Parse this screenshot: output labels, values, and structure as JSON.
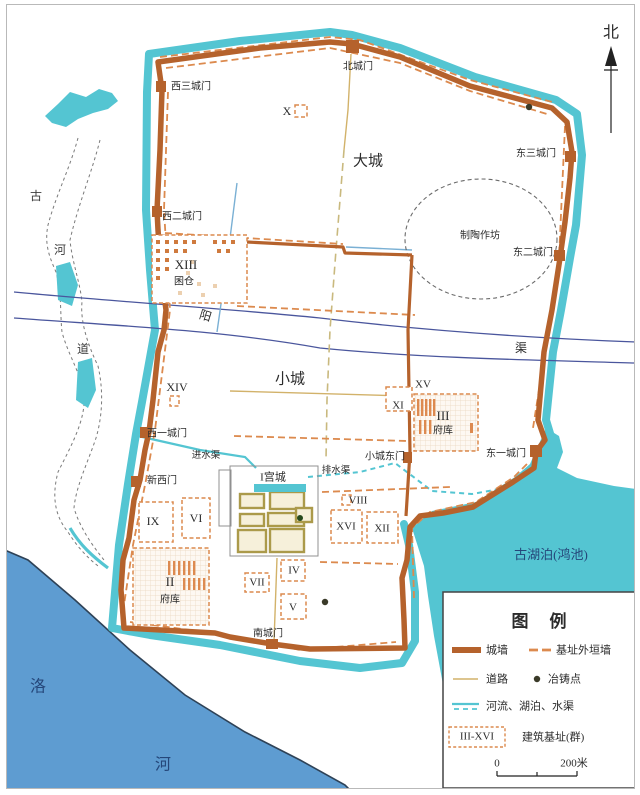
{
  "compass": {
    "north": "北"
  },
  "regions": {
    "dacheng": "大城",
    "xiaocheng": "小城",
    "gongcheng": "I宫城",
    "pottery": "制陶作坊"
  },
  "gates": {
    "north": "北城门",
    "west3": "西三城门",
    "west2": "西二城门",
    "west1": "西一城门",
    "new_west": "新西门",
    "east3": "东三城门",
    "east2": "东二城门",
    "east1": "东一城门",
    "xiaocheng_east": "小城东门",
    "south": "南城门"
  },
  "waterways": {
    "yang_char1": "阳",
    "yang_char2": "渠",
    "inlet": "进水渠",
    "drain": "排水渠",
    "old_river_char1": "古",
    "old_river_char2": "河",
    "old_river_char3": "道",
    "luo_char1": "洛",
    "luo_char2": "河",
    "lake": "古湖泊(鸿池)"
  },
  "sites": {
    "x": "X",
    "xiii": "XIII",
    "xiii_name": "囷仓",
    "xiv": "XIV",
    "xv": "XV",
    "xi": "XI",
    "iii": "III",
    "iii_name": "府库",
    "viii": "VIII",
    "xvi": "XVI",
    "xii": "XII",
    "ix": "IX",
    "vi": "VI",
    "iv": "IV",
    "vii": "VII",
    "v": "V",
    "ii": "II",
    "ii_name": "府库"
  },
  "legend": {
    "title": "图　例",
    "items": {
      "wall": "城墙",
      "foundation_wall": "基址外垣墙",
      "road": "道路",
      "casting_site": "冶铸点",
      "water": "河流、湖泊、水渠",
      "sites_range": "III-XVI",
      "sites_label": "建筑基址(群)"
    },
    "scale": {
      "start": "0",
      "end": "200米"
    }
  },
  "colors": {
    "wall": "#b5622c",
    "foundation_wall": "#dc8a4e",
    "road": "#d2b26a",
    "moat_water": "#54c5d2",
    "river_water": "#5e9cd1",
    "canal_line": "#4a569d",
    "text": "#2b2b2b",
    "water_text": "#25477a"
  }
}
